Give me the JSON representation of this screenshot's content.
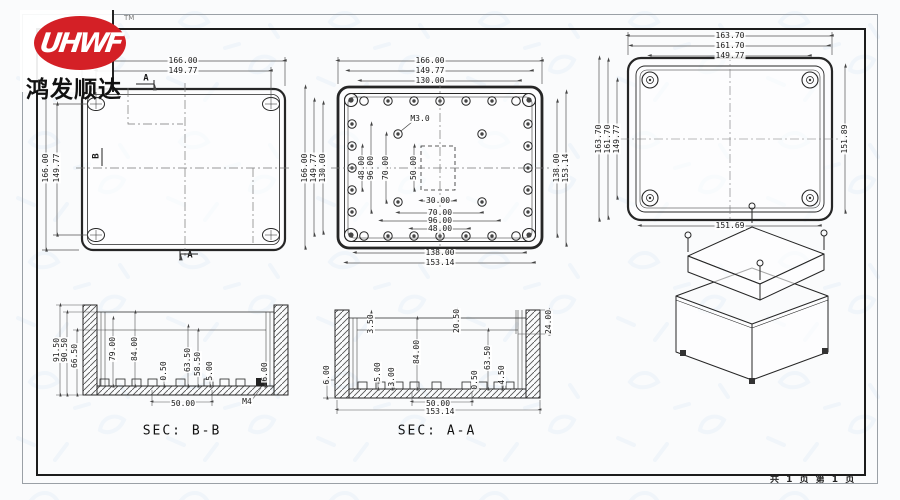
{
  "logo": {
    "brand": "UHWF",
    "tm": "TM",
    "company": "鸿发顺达"
  },
  "footer": {
    "page_info": "共 1 页   第 1 页"
  },
  "captions": {
    "sec_bb": "SEC: B-B",
    "sec_aa": "SEC: A-A"
  },
  "colors": {
    "logo_red": "#d42026",
    "line": "#262626",
    "dim_line": "#555555",
    "watermark_blue": "#b7d4ee"
  },
  "views": {
    "top_view_base": "plain top view with A-A and B-B section marks",
    "inside_view_base": "internal view with M3.0 screw bosses",
    "lid_view": "cover outside view",
    "section_bb": "cross section B-B",
    "section_aa": "cross section A-A",
    "isometric": "exploded 3D view of enclosure with corner screws"
  },
  "dim_labels": [
    {
      "t": "166.00",
      "x": 183,
      "y": 61
    },
    {
      "t": "149.77",
      "x": 183,
      "y": 71
    },
    {
      "t": "166.00",
      "x": 46,
      "y": 168,
      "r": 1
    },
    {
      "t": "149.77",
      "x": 57,
      "y": 168,
      "r": 1
    },
    {
      "t": "A",
      "x": 146,
      "y": 79,
      "cls": "mark"
    },
    {
      "t": "A",
      "x": 190,
      "y": 256,
      "cls": "mark"
    },
    {
      "t": "B",
      "x": 97,
      "y": 156,
      "r": 1,
      "cls": "mark"
    },
    {
      "t": "166.00",
      "x": 430,
      "y": 61
    },
    {
      "t": "149.77",
      "x": 430,
      "y": 71
    },
    {
      "t": "130.00",
      "x": 430,
      "y": 81
    },
    {
      "t": "166.00",
      "x": 305,
      "y": 168,
      "r": 1
    },
    {
      "t": "149.77",
      "x": 314,
      "y": 168,
      "r": 1
    },
    {
      "t": "130.00",
      "x": 323,
      "y": 168,
      "r": 1
    },
    {
      "t": "M3.0",
      "x": 420,
      "y": 119
    },
    {
      "t": "48.00",
      "x": 362,
      "y": 168,
      "r": 1
    },
    {
      "t": "96.00",
      "x": 371,
      "y": 168,
      "r": 1
    },
    {
      "t": "70.00",
      "x": 386,
      "y": 168,
      "r": 1
    },
    {
      "t": "50.00",
      "x": 414,
      "y": 168,
      "r": 1
    },
    {
      "t": "30.00",
      "x": 438,
      "y": 201
    },
    {
      "t": "70.00",
      "x": 440,
      "y": 213
    },
    {
      "t": "96.00",
      "x": 440,
      "y": 221
    },
    {
      "t": "48.00",
      "x": 440,
      "y": 229
    },
    {
      "t": "138.00",
      "x": 557,
      "y": 168,
      "r": 1
    },
    {
      "t": "153.14",
      "x": 566,
      "y": 168,
      "r": 1
    },
    {
      "t": "138.00",
      "x": 440,
      "y": 253
    },
    {
      "t": "153.14",
      "x": 440,
      "y": 263
    },
    {
      "t": "163.70",
      "x": 730,
      "y": 36
    },
    {
      "t": "161.70",
      "x": 730,
      "y": 46
    },
    {
      "t": "149.77",
      "x": 730,
      "y": 56
    },
    {
      "t": "163.70",
      "x": 599,
      "y": 139,
      "r": 1
    },
    {
      "t": "161.70",
      "x": 608,
      "y": 139,
      "r": 1
    },
    {
      "t": "149.77",
      "x": 617,
      "y": 139,
      "r": 1
    },
    {
      "t": "151.89",
      "x": 845,
      "y": 139,
      "r": 1
    },
    {
      "t": "151.69",
      "x": 730,
      "y": 226
    },
    {
      "t": "91.50",
      "x": 57,
      "y": 350,
      "r": 1
    },
    {
      "t": "90.50",
      "x": 65,
      "y": 350,
      "r": 1
    },
    {
      "t": "66.50",
      "x": 75,
      "y": 356,
      "r": 1
    },
    {
      "t": "79.00",
      "x": 113,
      "y": 349,
      "r": 1
    },
    {
      "t": "84.00",
      "x": 135,
      "y": 349,
      "r": 1
    },
    {
      "t": "0.50",
      "x": 164,
      "y": 371,
      "r": 1
    },
    {
      "t": "63.50",
      "x": 188,
      "y": 360,
      "r": 1
    },
    {
      "t": "58.50",
      "x": 198,
      "y": 364,
      "r": 1
    },
    {
      "t": "5.00",
      "x": 210,
      "y": 371,
      "r": 1
    },
    {
      "t": "6.00",
      "x": 265,
      "y": 372,
      "r": 1
    },
    {
      "t": "50.00",
      "x": 183,
      "y": 404
    },
    {
      "t": "M4",
      "x": 247,
      "y": 402
    },
    {
      "t": "SEC: B-B",
      "x": 182,
      "y": 431,
      "cls": "cap"
    },
    {
      "t": "3.50",
      "x": 371,
      "y": 324,
      "r": 1
    },
    {
      "t": "20.50",
      "x": 457,
      "y": 321,
      "r": 1
    },
    {
      "t": "24.00",
      "x": 549,
      "y": 322,
      "r": 1
    },
    {
      "t": "84.00",
      "x": 417,
      "y": 352,
      "r": 1
    },
    {
      "t": "5.00",
      "x": 378,
      "y": 372,
      "r": 1
    },
    {
      "t": "3.00",
      "x": 392,
      "y": 377,
      "r": 1
    },
    {
      "t": "63.50",
      "x": 488,
      "y": 358,
      "r": 1
    },
    {
      "t": "0.50",
      "x": 475,
      "y": 380,
      "r": 1
    },
    {
      "t": "4.50",
      "x": 502,
      "y": 375,
      "r": 1
    },
    {
      "t": "6.00",
      "x": 327,
      "y": 375,
      "r": 1
    },
    {
      "t": "50.00",
      "x": 438,
      "y": 404
    },
    {
      "t": "153.14",
      "x": 440,
      "y": 412
    },
    {
      "t": "SEC: A-A",
      "x": 437,
      "y": 431,
      "cls": "cap"
    }
  ]
}
